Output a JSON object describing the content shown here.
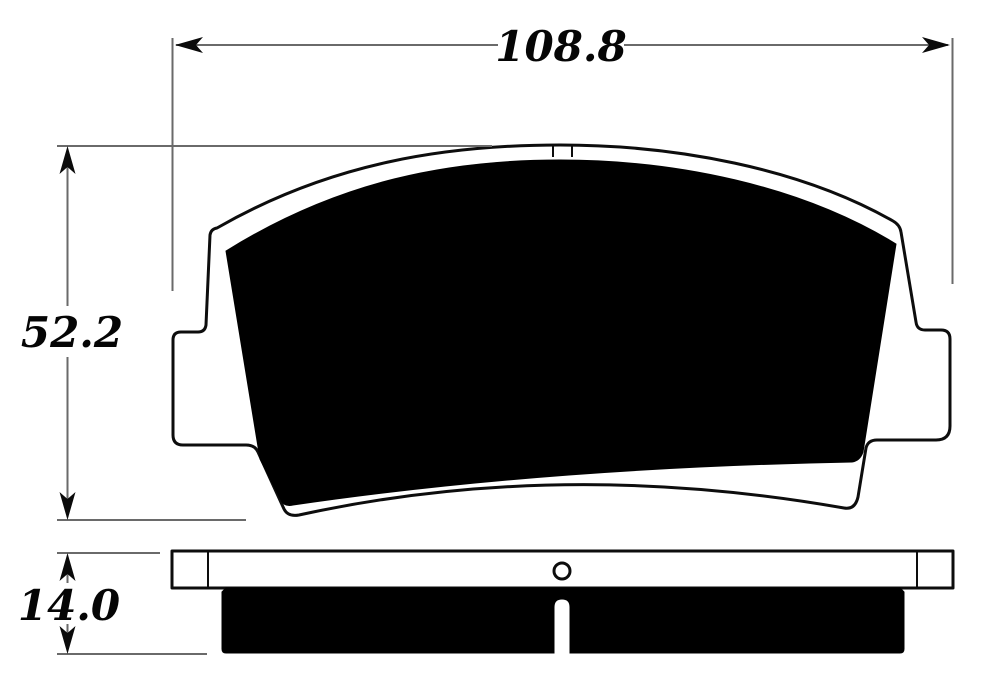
{
  "drawing": {
    "type": "technical-dimension-drawing",
    "subject": "disc brake pad, front view and side profile view",
    "dimensions": {
      "width": "108.8",
      "height": "52.2",
      "thickness": "14.0"
    },
    "colors": {
      "outline": "#0d0d0d",
      "friction_fill": "#000000",
      "dimension_lines": "#6a6a6a",
      "text": "#050505",
      "background": "#ffffff"
    }
  }
}
